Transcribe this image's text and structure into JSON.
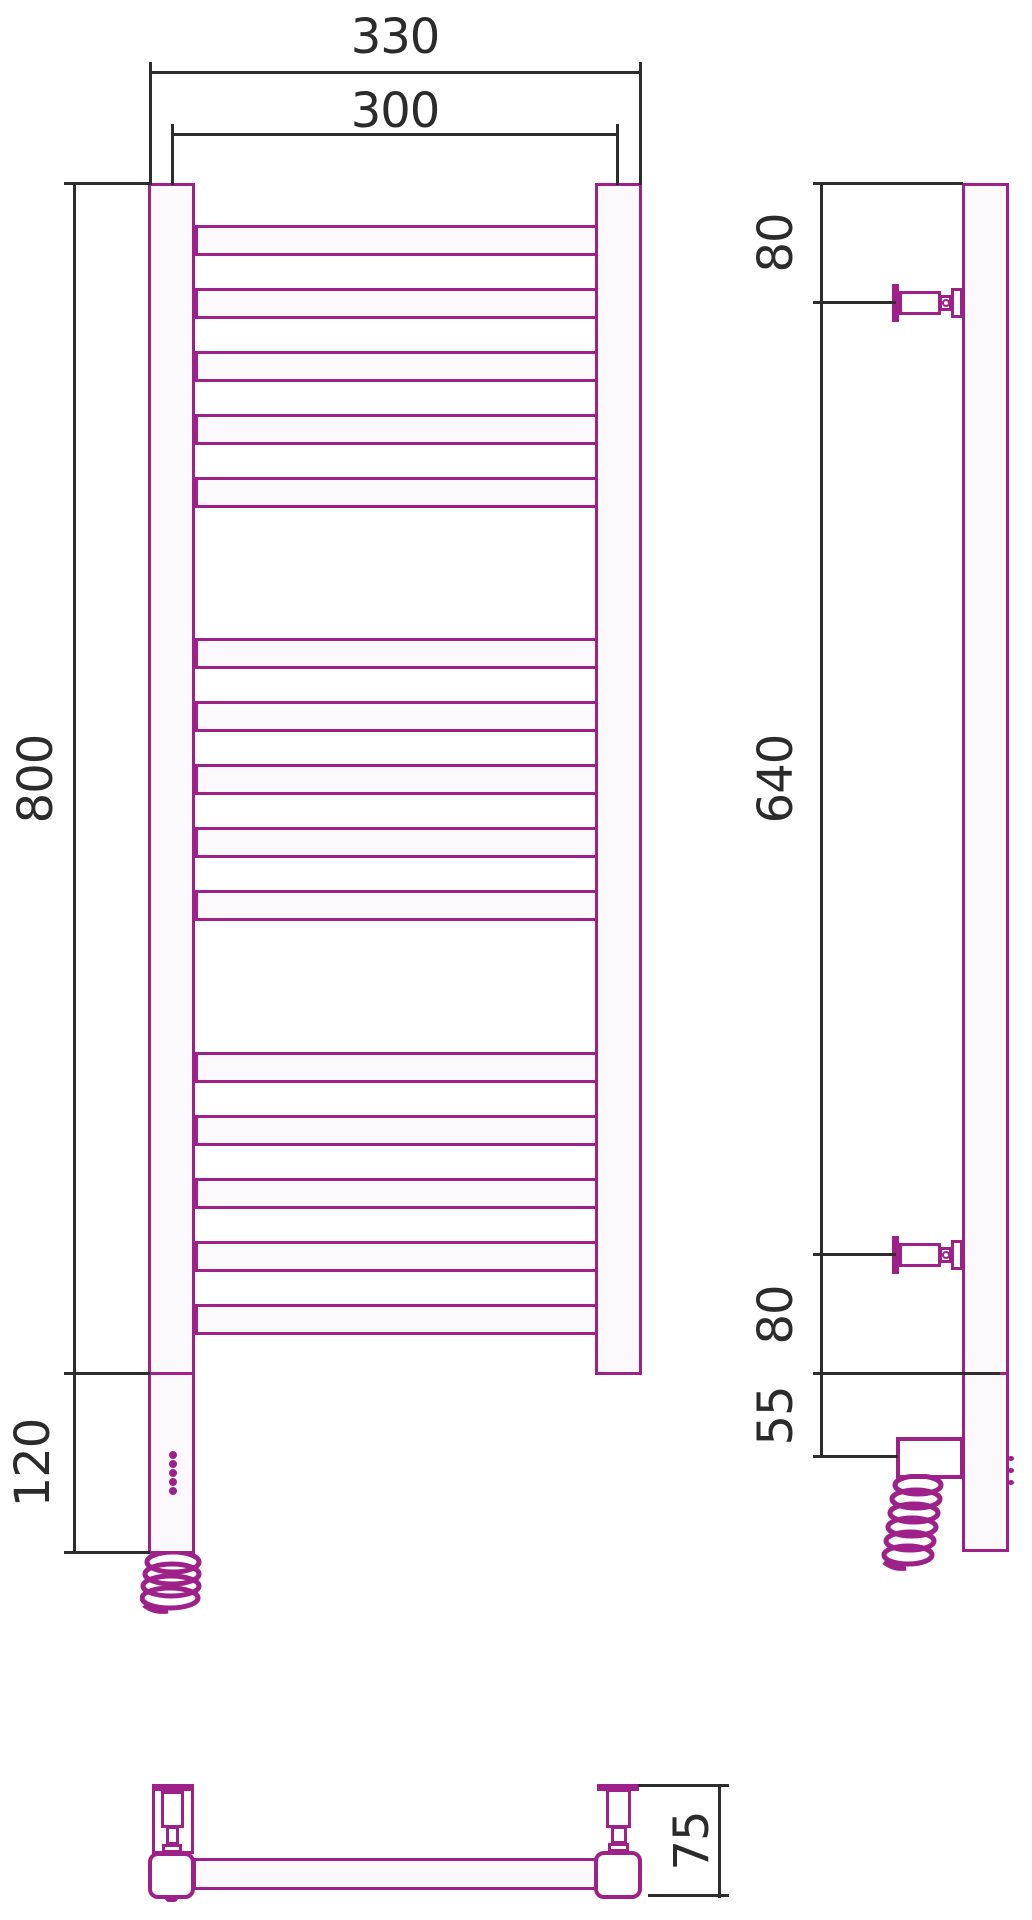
{
  "title": "heated-towel-rail-technical-drawing",
  "colors": {
    "product_outline": "#9E2089",
    "dimension_lines": "#2D2D2D",
    "background": "#FFFFFF"
  },
  "dims": {
    "overall_width": "330",
    "rail_width": "300",
    "overall_height": "800",
    "heater_height": "120",
    "side_top_offset": "80",
    "side_bracket_span": "640",
    "side_bottom_offset": "80",
    "side_under_offset": "55",
    "depth": "75"
  },
  "front": {
    "tube_group_count": 3,
    "tubes_per_group": 5,
    "group_tops": [
      225,
      638,
      1052
    ],
    "tube_pitch": 63,
    "led_count": 5,
    "led_first_top": 1451,
    "led_step": 9
  },
  "side": {
    "bracket_centers": [
      303,
      1255
    ],
    "led_count": 3,
    "led_first_top": 1456,
    "led_step": 12
  }
}
